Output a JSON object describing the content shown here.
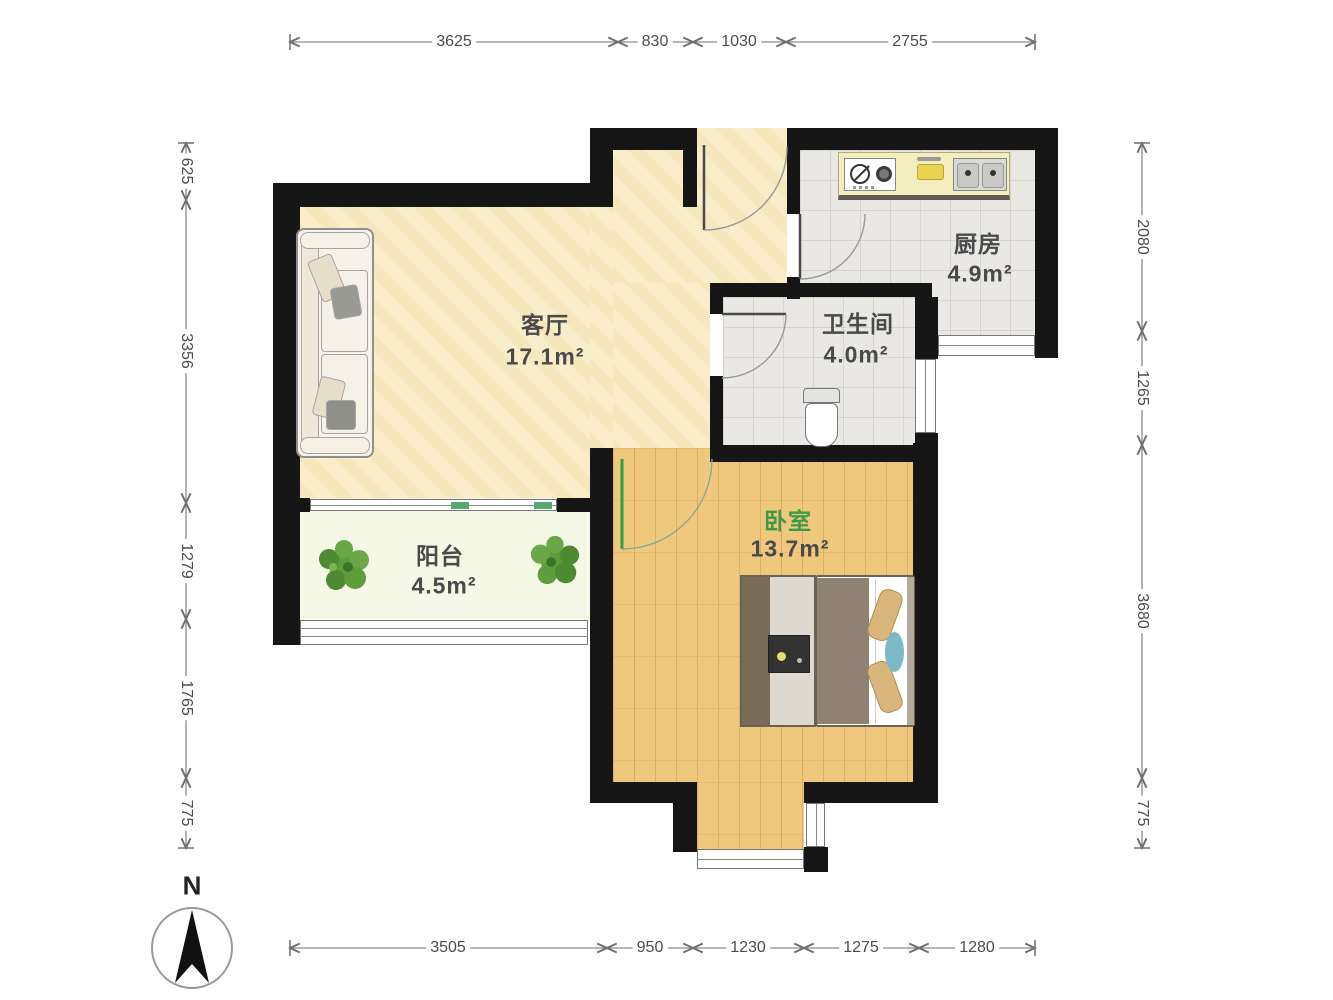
{
  "compass": {
    "label": "N"
  },
  "rooms": {
    "living": {
      "name": "客厅",
      "area": "17.1m²"
    },
    "kitchen": {
      "name": "厨房",
      "area": "4.9m²"
    },
    "bath": {
      "name": "卫生间",
      "area": "4.0m²"
    },
    "bedroom": {
      "name": "卧室",
      "area": "13.7m²"
    },
    "balcony": {
      "name": "阳台",
      "area": "4.5m²"
    }
  },
  "dims": {
    "top": [
      "3625",
      "830",
      "1030",
      "2755"
    ],
    "left": [
      "625",
      "3356",
      "1279",
      "1765",
      "775"
    ],
    "right": [
      "2080",
      "1265",
      "3680",
      "775"
    ],
    "bottom": [
      "3505",
      "950",
      "1230",
      "1275",
      "1280"
    ]
  },
  "colors": {
    "wall": "#161616",
    "living_floor": "#f9eec9",
    "wood_floor": "#efc87d",
    "tile_floor": "#e9e8e4",
    "balcony_floor": "#f5f8e6",
    "bedroom_label_green": "#3f9a44",
    "label_gray": "#4a4a4a",
    "door_green": "#2f9e4e"
  }
}
